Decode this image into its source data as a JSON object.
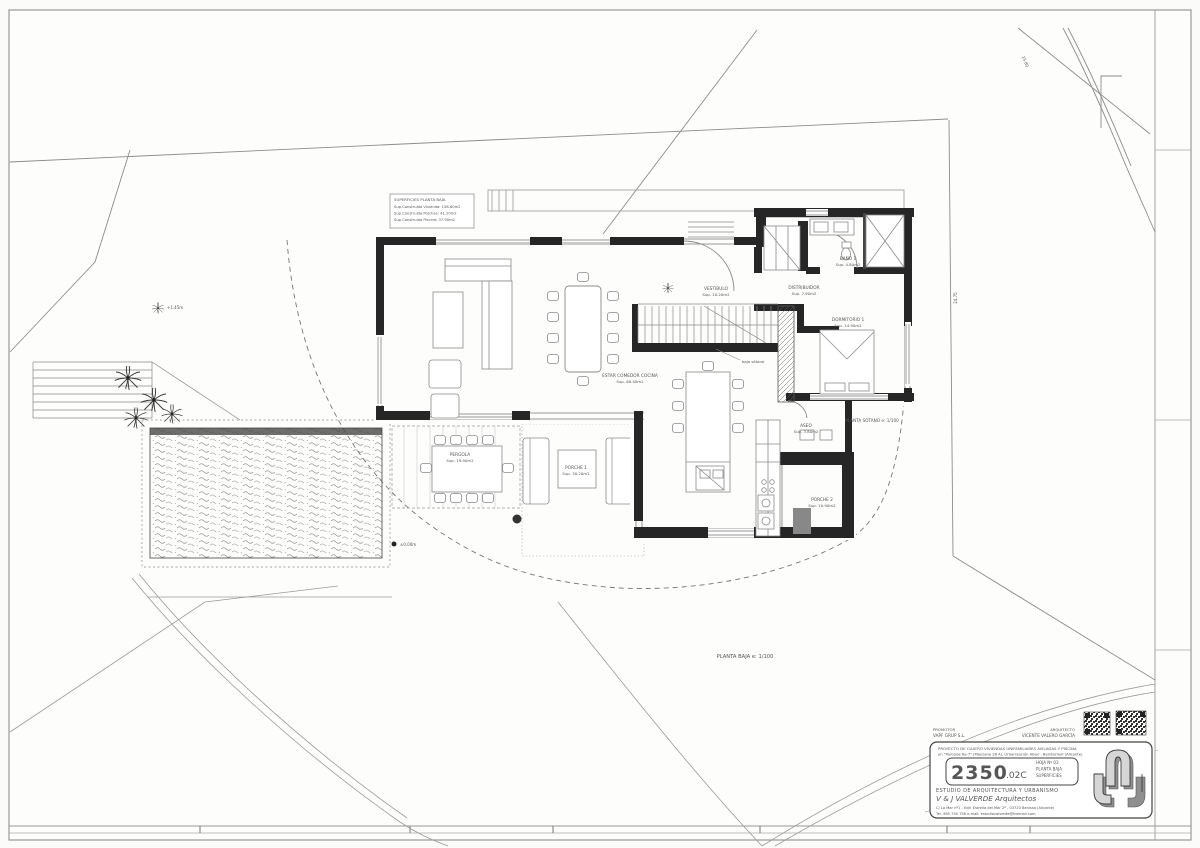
{
  "legend": {
    "title": "SUPERFICIES PLANTA BAJA",
    "lines": [
      "Sup.Construida Vivienda: 158.80m2",
      "Sup.Construida Porches: 41.10m2",
      "Sup.Construida Piscina: 37.90m2"
    ]
  },
  "rooms": {
    "estar": {
      "name": "ESTAR COMEDOR COCINA",
      "area": "Sup. 60.40m2"
    },
    "vestibulo": {
      "name": "VESTIBULO",
      "area": "Sup. 10.20m2"
    },
    "distribuidor": {
      "name": "DISTRIBUIDOR",
      "area": "Sup. 7.90m2"
    },
    "bano1": {
      "name": "BAÑO 1",
      "area": "Sup. 4.80m2"
    },
    "dormitorio1": {
      "name": "DORMITORIO 1",
      "area": "Sup. 14.90m2"
    },
    "aseo": {
      "name": "ASEO",
      "area": "Sup. 3.80m2"
    },
    "porche2": {
      "name": "PORCHE 2",
      "area": "Sup. 10.90m2"
    },
    "porche1": {
      "name": "PORCHE 1",
      "area": "Sup. 30.20m2"
    },
    "pergola": {
      "name": "PERGOLA",
      "area": "Sup. 19.90m2"
    }
  },
  "annotations": {
    "planta_baja": "PLANTA  BAJA   e: 1/100",
    "planta_sotano": "PLANTA  SÓTANO   e: 1/100",
    "baja_sotano": "baja sótano",
    "level_terrace": "+1.45m",
    "level_pool": "±0.00m",
    "dim_east": "24.75",
    "dim_northeast": "15.80"
  },
  "title_block": {
    "promoter_label": "PROMOTOR",
    "promoter_name": "VAPF GRUP S.L.",
    "architect_label": "ARQUITECTO",
    "architect_name": "VICENTE VALERO GARCÍA",
    "project_line1": "PROYECTO DE CUATRO VIVIENDAS UNIFAMILIARES AISLADAS Y PISCINA",
    "project_line2": "en \"Parcelas 6a-7\" (Manzana 28 A), Urbanización Abiar - Benitachell (Alicante)",
    "number": "2350",
    "number_suffix": ".02C",
    "info_line1": "HOJA Nº 03",
    "info_line2": "PLANTA BAJA",
    "info_line3": "SUPERFICIES",
    "studio_line1": "ESTUDIO DE ARQUITECTURA Y URBANISMO",
    "studio_line2": "V & J VALVERDE  Arquitectos",
    "address_line1": "C/ La Mar nº1 - Edif. Estrella del Mar 2º - 03720 Benissa (Alicante)",
    "address_line2": "Tel. 965 730 758   e-mail: estudiovalverde@hotmail.com"
  }
}
